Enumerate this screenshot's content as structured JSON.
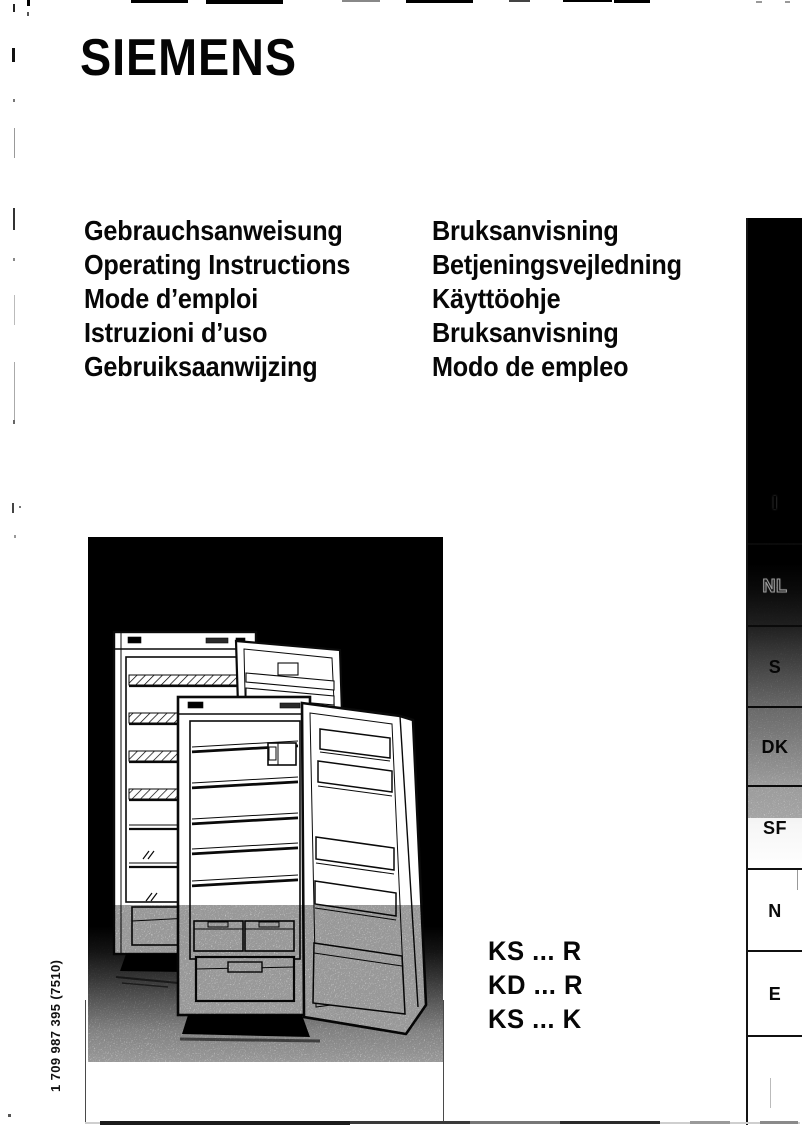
{
  "brand": {
    "name": "SIEMENS"
  },
  "languages": {
    "left": [
      "Gebrauchsanweisung",
      "Operating Instructions",
      "Mode d’emploi",
      "Istruzioni d’uso",
      "Gebruiksaanwijzing"
    ],
    "right": [
      "Bruksanvisning",
      "Betjeningsvejledning",
      "Käyttöohje",
      "Bruksanvisning",
      "Modo de empleo"
    ]
  },
  "models": [
    "KS ... R",
    "KD ... R",
    "KS ... K"
  ],
  "part_number": "1 709 987 395 (7510)",
  "sidebar": {
    "tabs": [
      "I",
      "NL",
      "S",
      "DK",
      "SF",
      "N",
      "E",
      ""
    ]
  },
  "illustration": {
    "name": "three-open-refrigerators-line-art"
  },
  "colors": {
    "ink": "#0a0a0a",
    "paper": "#ffffff",
    "image_background": "#000000"
  }
}
